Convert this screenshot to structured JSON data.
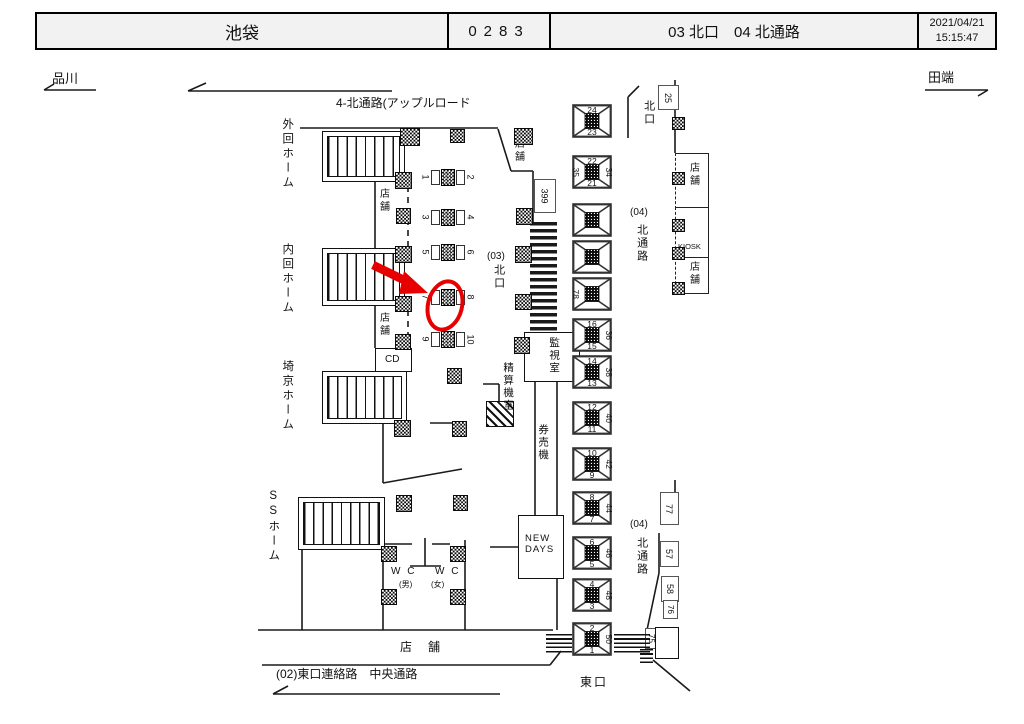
{
  "header": {
    "station": "池袋",
    "code": "0283",
    "location": "03 北口　04 北通路",
    "date": "2021/04/21",
    "time": "15:15:47"
  },
  "nav": {
    "left_station": "品川",
    "right_station": "田端"
  },
  "map": {
    "passage_label": "4-北通路(アップルロード",
    "platforms": {
      "outer": "外回ホーム",
      "inner": "内回ホーム",
      "saikyo": "埼京ホーム",
      "ss": "SSホーム"
    },
    "rooms": {
      "shop": "店舗",
      "cd": "CD",
      "kiosk": "KIOSK",
      "new_days": "NEW DAYS",
      "monitor_room": "監視室",
      "fare_adjust_room": "精算機室",
      "ticket_machines": "券売機",
      "wc_label": "W C",
      "wc_men": "(男)",
      "wc_women": "(女)",
      "shop_bottom": "店　舗"
    },
    "exits": {
      "north_gate": "北口",
      "north_gate_03": "(03)",
      "north_gate_03_v": "北口",
      "north_passage_04": "(04)",
      "north_passage_04_v": "北通路",
      "east_exit": "東口",
      "east_link": "(02)東口連絡路　中央通路"
    },
    "tags": {
      "t399": "399",
      "t25": "25",
      "t77": "77",
      "t57": "57",
      "t58": "58",
      "t76": "76",
      "t75": "75"
    },
    "gate_pairs": [
      {
        "left": "1",
        "right": "2"
      },
      {
        "left": "3",
        "right": "4"
      },
      {
        "left": "5",
        "right": "6"
      },
      {
        "left": "7",
        "right": "8"
      },
      {
        "left": "9",
        "right": "10"
      }
    ],
    "stairway_boxes": [
      {
        "top": "24",
        "bottom": "23"
      },
      {
        "top": "22",
        "bottom": "21",
        "left": "35",
        "right": "34"
      },
      {},
      {},
      {
        "left": "78"
      },
      {
        "top": "16",
        "bottom": "15",
        "right": "36"
      },
      {
        "top": "14",
        "bottom": "13",
        "right": "38"
      },
      {
        "top": "12",
        "bottom": "11",
        "right": "40"
      },
      {
        "top": "10",
        "bottom": "9",
        "right": "42"
      },
      {
        "top": "8",
        "bottom": "7",
        "right": "44"
      },
      {
        "top": "6",
        "bottom": "5",
        "right": "46"
      },
      {
        "top": "4",
        "bottom": "3",
        "right": "48"
      },
      {
        "top": "2",
        "bottom": "1",
        "right": "50"
      }
    ]
  },
  "annotation": {
    "highlighted_gate": "7",
    "color": "#e60000"
  },
  "colors": {
    "wall": "#1a1a1a",
    "header_bg": "#f2f2f2",
    "annotation": "#e60000"
  }
}
